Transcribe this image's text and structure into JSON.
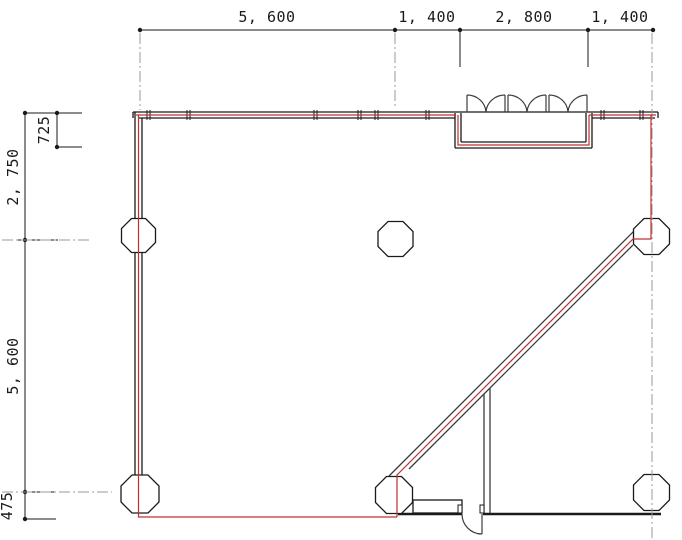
{
  "drawing": {
    "type": "architectural-floor-plan",
    "dimensions": {
      "top": {
        "d1": "5, 600",
        "d2": "1, 400",
        "d3": "2, 800",
        "d4": "1, 400"
      },
      "left": {
        "recess_depth": "725",
        "upper_bay": "2, 750",
        "lower_bay": "5, 600",
        "bottom_offset": "475"
      }
    },
    "colors": {
      "wall_red": "#c03030",
      "line_black": "#1a1a1a",
      "wall_dark": "#3c3c3c",
      "centerline_gray": "#9a9a9a"
    }
  }
}
